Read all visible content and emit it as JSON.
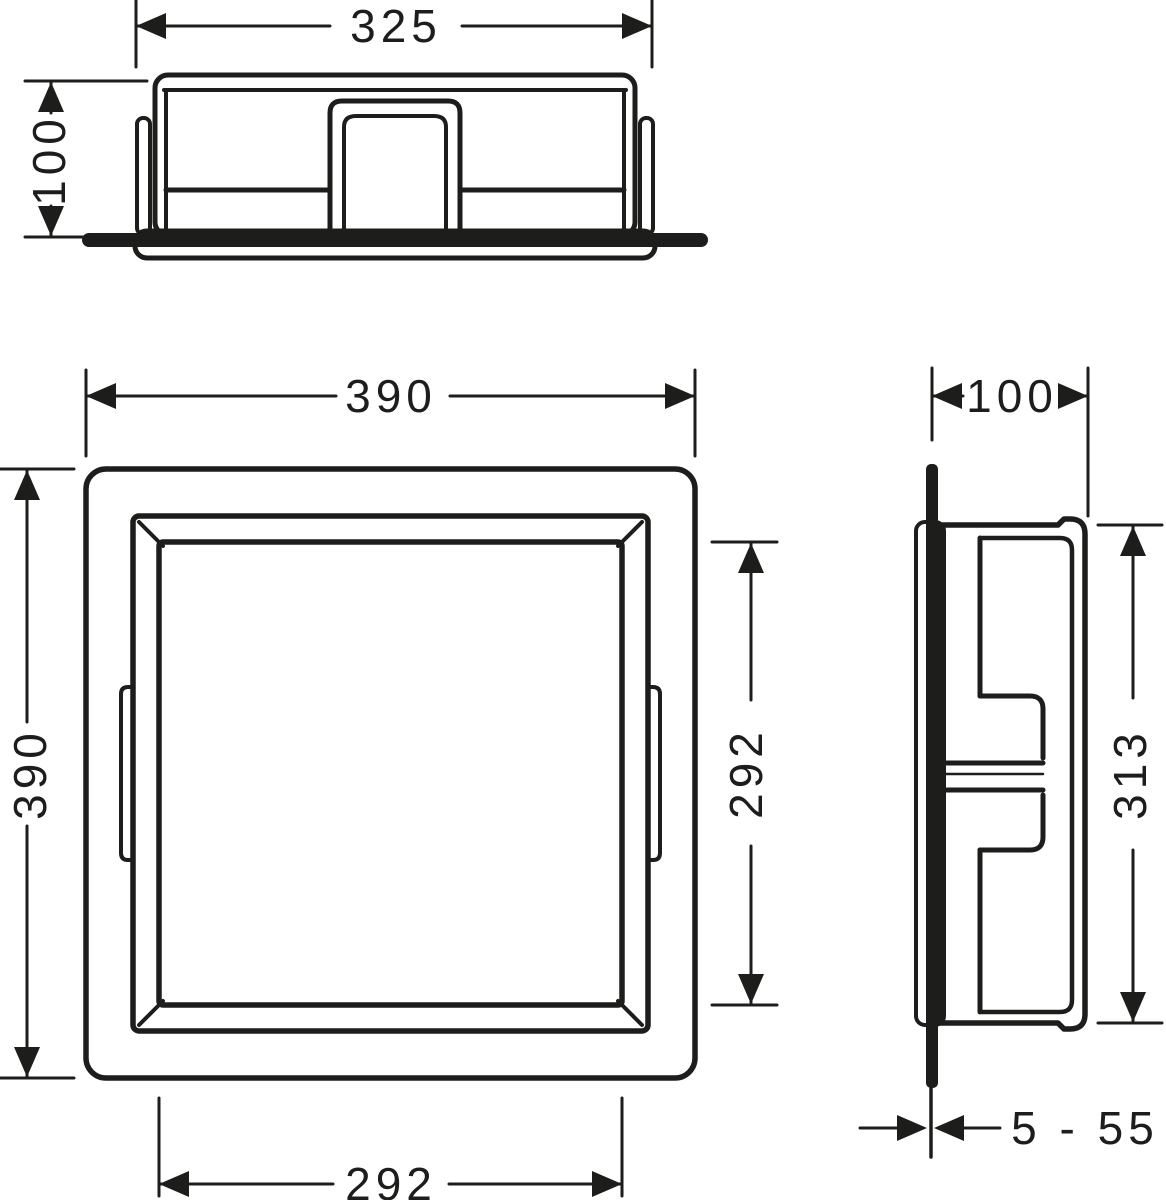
{
  "colors": {
    "line": "#1d1d1b",
    "background": "#ffffff"
  },
  "dimensions": {
    "top_view": {
      "width_label": "325",
      "depth_label": "100"
    },
    "front_view": {
      "outer_width_label": "390",
      "outer_height_label": "390",
      "inner_height_label": "292",
      "inner_width_label": "292"
    },
    "side_view": {
      "depth_label": "100",
      "height_label": "313",
      "depth_range_label": "5 - 55"
    }
  }
}
